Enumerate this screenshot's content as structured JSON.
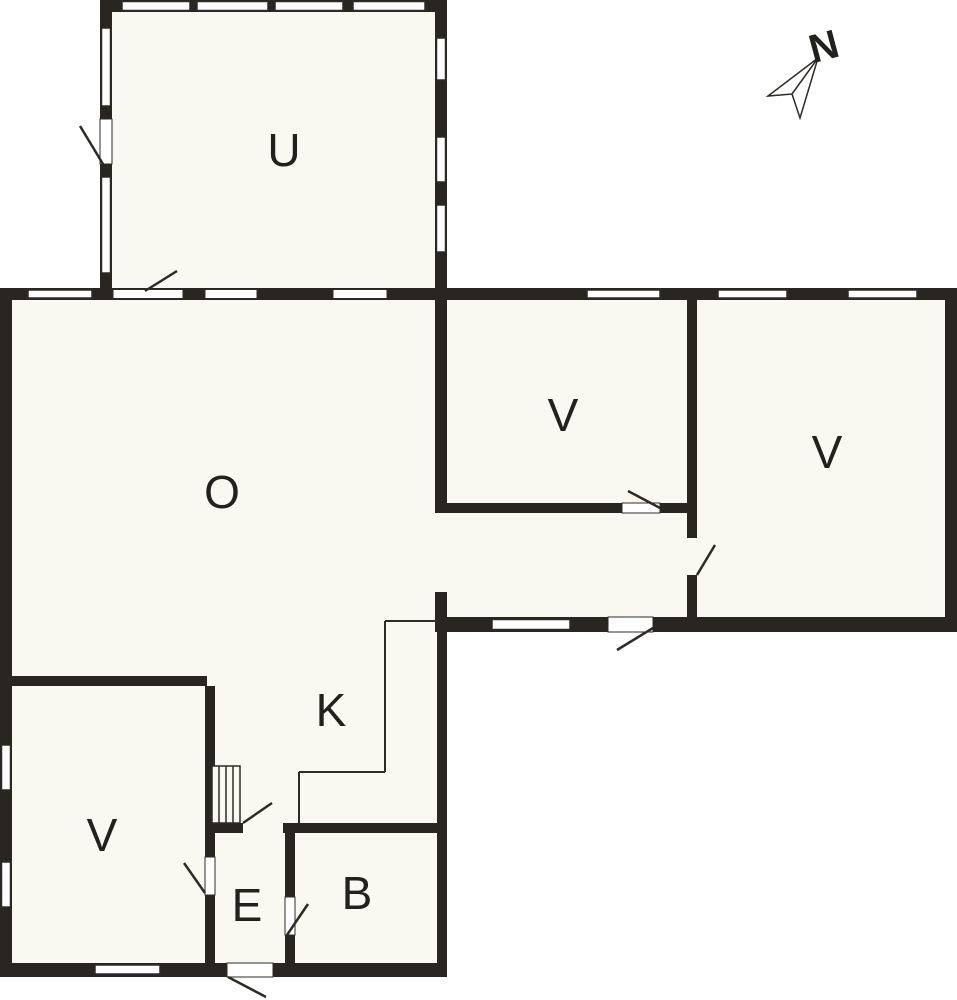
{
  "colors": {
    "wall": "#292622",
    "floor": "#f9f8f1",
    "outside": "#ffffff",
    "line": "#2e2b27",
    "label": "#23211e"
  },
  "canvas": {
    "w": 957,
    "h": 1000
  },
  "floors": [
    [
      0,
      288,
      447,
      689
    ],
    [
      447,
      288,
      510,
      344
    ],
    [
      100,
      0,
      347,
      288
    ]
  ],
  "walls": [
    [
      100,
      0,
      347,
      12
    ],
    [
      100,
      0,
      12,
      290
    ],
    [
      435,
      0,
      12,
      300
    ],
    [
      0,
      288,
      957,
      12
    ],
    [
      0,
      288,
      12,
      689
    ],
    [
      945,
      288,
      12,
      344
    ],
    [
      435,
      300,
      12,
      213
    ],
    [
      435,
      592,
      12,
      40
    ],
    [
      437,
      503,
      251,
      10
    ],
    [
      687,
      300,
      10,
      238
    ],
    [
      687,
      575,
      10,
      57
    ],
    [
      437,
      617,
      520,
      15
    ],
    [
      12,
      676,
      195,
      10
    ],
    [
      205,
      686,
      10,
      277
    ],
    [
      205,
      823,
      38,
      10
    ],
    [
      283,
      823,
      164,
      10
    ],
    [
      285,
      833,
      10,
      130
    ],
    [
      437,
      632,
      10,
      345
    ],
    [
      0,
      963,
      447,
      14
    ]
  ],
  "openings": [
    [
      100,
      119,
      12,
      45
    ],
    [
      113,
      289.5,
      70,
      9
    ],
    [
      205,
      289.5,
      52,
      9
    ],
    [
      333,
      289.5,
      54,
      9
    ],
    [
      622,
      503,
      38,
      10
    ],
    [
      608,
      617,
      45,
      15
    ],
    [
      205,
      857,
      10,
      38
    ],
    [
      285,
      897,
      10,
      38
    ],
    [
      227,
      963,
      46,
      14
    ]
  ],
  "windows": [
    [
      122,
      1.5,
      68,
      9
    ],
    [
      197,
      1.5,
      71,
      9
    ],
    [
      275,
      1.5,
      68,
      9
    ],
    [
      353,
      1.5,
      72,
      9
    ],
    [
      101.5,
      28,
      9,
      78
    ],
    [
      101.5,
      177,
      9,
      96
    ],
    [
      436.5,
      38,
      9,
      42
    ],
    [
      436.5,
      137,
      9,
      45
    ],
    [
      436.5,
      205,
      9,
      47
    ],
    [
      28,
      290,
      64,
      8
    ],
    [
      587,
      290,
      73,
      8
    ],
    [
      718,
      290,
      69,
      8
    ],
    [
      848,
      290,
      69,
      8
    ],
    [
      1.5,
      745,
      9,
      45
    ],
    [
      1.5,
      862,
      9,
      45
    ],
    [
      95,
      965,
      65,
      9
    ],
    [
      492,
      619.5,
      78,
      10
    ]
  ],
  "thin_lines": [
    [
      437,
      621,
      385,
      621
    ],
    [
      385,
      621,
      385,
      772
    ],
    [
      385,
      772,
      299,
      772
    ],
    [
      299,
      772,
      299,
      823
    ]
  ],
  "door_swings": [
    [
      103,
      164,
      80,
      126
    ],
    [
      145,
      291,
      177,
      271
    ],
    [
      660,
      508,
      628,
      491
    ],
    [
      697,
      575,
      715,
      545
    ],
    [
      653,
      628,
      617,
      650
    ],
    [
      205,
      893,
      184,
      863
    ],
    [
      287,
      935,
      308,
      904
    ],
    [
      228,
      977,
      266,
      997
    ],
    [
      243,
      823,
      272,
      803
    ]
  ],
  "stairs": {
    "x": 212,
    "y": 766,
    "w": 28,
    "h": 57,
    "treads": [
      219,
      226,
      233
    ]
  },
  "rooms": [
    {
      "name": "u",
      "label": "U",
      "x": 284,
      "y": 150
    },
    {
      "name": "o",
      "label": "O",
      "x": 222,
      "y": 492
    },
    {
      "name": "v-middle",
      "label": "V",
      "x": 563,
      "y": 415
    },
    {
      "name": "v-east",
      "label": "V",
      "x": 827,
      "y": 452
    },
    {
      "name": "k",
      "label": "K",
      "x": 331,
      "y": 710
    },
    {
      "name": "v-south",
      "label": "V",
      "x": 102,
      "y": 835
    },
    {
      "name": "e",
      "label": "E",
      "x": 247,
      "y": 905
    },
    {
      "name": "b",
      "label": "B",
      "x": 357,
      "y": 893
    }
  ],
  "label_font_size": 46,
  "north": {
    "label": "N",
    "x": 824,
    "y": 47,
    "rotation": -15,
    "font_size": 40,
    "needle_points": "818,58 768,96 792,94 800,118",
    "fold_line": [
      792,
      94,
      818,
      58
    ]
  }
}
